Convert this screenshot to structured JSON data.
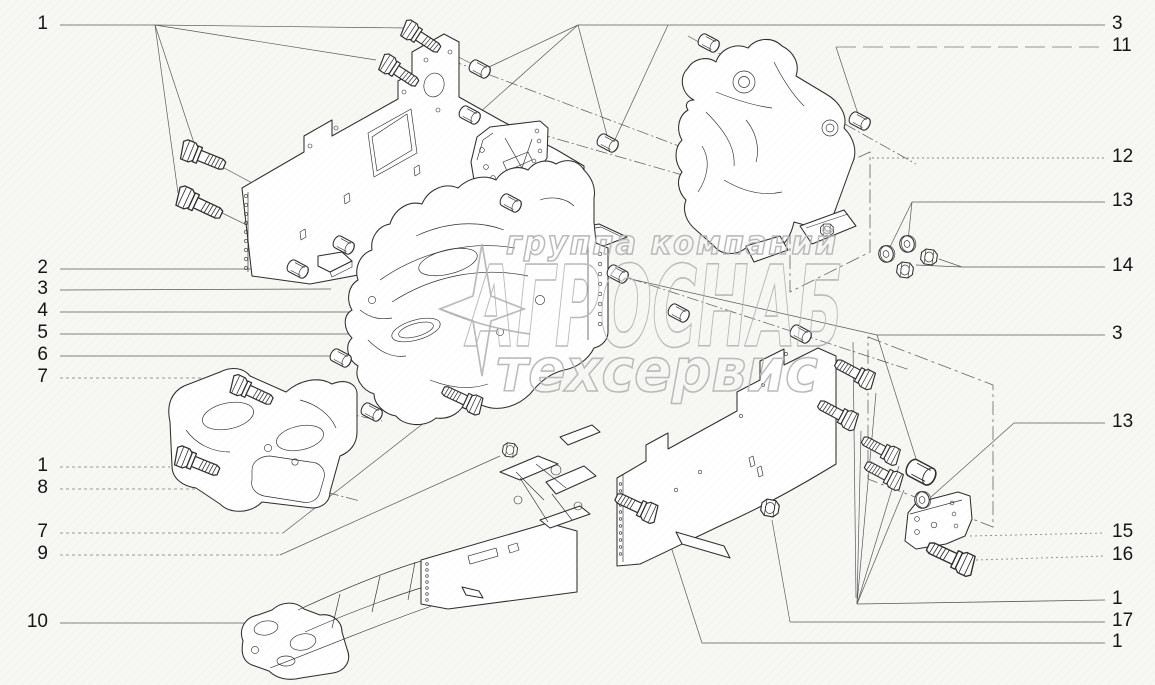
{
  "title": "exploded-parts-diagram",
  "watermark": {
    "line1": "группа компаний",
    "line2": "АГРОСНАБ",
    "line3": "техсервис",
    "color": "#b4b4b4"
  },
  "callouts": {
    "left": [
      {
        "n": "1",
        "y": 25
      },
      {
        "n": "2",
        "y": 269
      },
      {
        "n": "3",
        "y": 290
      },
      {
        "n": "4",
        "y": 312
      },
      {
        "n": "5",
        "y": 334
      },
      {
        "n": "6",
        "y": 356
      },
      {
        "n": "7",
        "y": 378
      },
      {
        "n": "1",
        "y": 467
      },
      {
        "n": "8",
        "y": 489
      },
      {
        "n": "7",
        "y": 533
      },
      {
        "n": "9",
        "y": 555
      },
      {
        "n": "10",
        "y": 623
      }
    ],
    "right": [
      {
        "n": "3",
        "y": 25
      },
      {
        "n": "11",
        "y": 47
      },
      {
        "n": "12",
        "y": 158
      },
      {
        "n": "13",
        "y": 202
      },
      {
        "n": "14",
        "y": 267
      },
      {
        "n": "3",
        "y": 335
      },
      {
        "n": "13",
        "y": 423
      },
      {
        "n": "15",
        "y": 533
      },
      {
        "n": "16",
        "y": 556
      },
      {
        "n": "1",
        "y": 600
      },
      {
        "n": "17",
        "y": 622
      },
      {
        "n": "1",
        "y": 643
      }
    ]
  },
  "style": {
    "background": "#f7f7f4",
    "line_color": "#2e2e2e",
    "leader_color": "#5a5a5a"
  }
}
